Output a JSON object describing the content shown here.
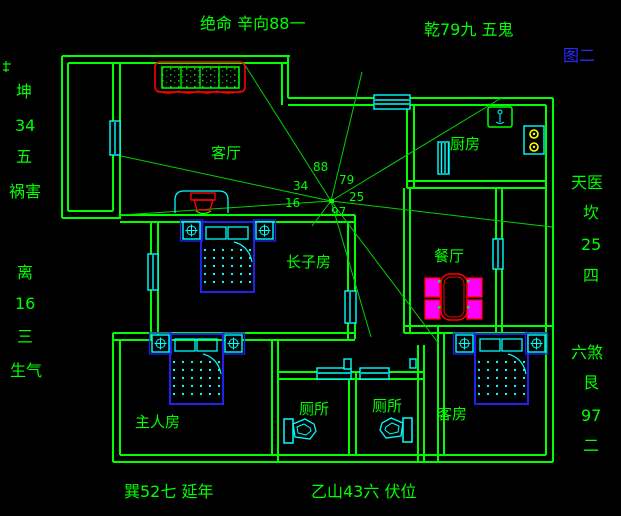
{
  "figure": {
    "label": "图二"
  },
  "compass": {
    "top_left": "绝命 辛向88一",
    "top_right": "乾79九 五鬼",
    "bottom_left": "巽52七 延年",
    "bottom_center": "乙山43六 伏位",
    "left_upper": {
      "trigram": "坤",
      "number": "34",
      "star": "五",
      "name": "祸害"
    },
    "left_lower": {
      "trigram": "离",
      "number": "16",
      "star": "三",
      "name": "生气"
    },
    "right_upper": {
      "name": "天医",
      "trigram": "坎",
      "number": "25",
      "star": "四"
    },
    "right_lower": {
      "name": "六煞",
      "trigram": "艮",
      "number": "97",
      "star": "二"
    },
    "center_numbers": {
      "n88": "88",
      "n79": "79",
      "n34": "34",
      "n25": "25",
      "n16": "16",
      "n97": "97"
    }
  },
  "rooms": {
    "living_room": "客厅",
    "kitchen": "厨房",
    "dining_room": "餐厅",
    "eldest_son_room": "长子房",
    "master_bedroom": "主人房",
    "toilet_left": "厕所",
    "toilet_right": "厕所",
    "guest_room": "客房"
  },
  "colors": {
    "background": "#000000",
    "wall_green": "#00ff00",
    "fixture_cyan": "#00ffff",
    "accent_red": "#ff0000",
    "chair_magenta": "#ff00ff",
    "bed_blue": "#2222ee",
    "burner_yellow": "#ffff00",
    "figure_label_blue": "#2a2aff"
  }
}
